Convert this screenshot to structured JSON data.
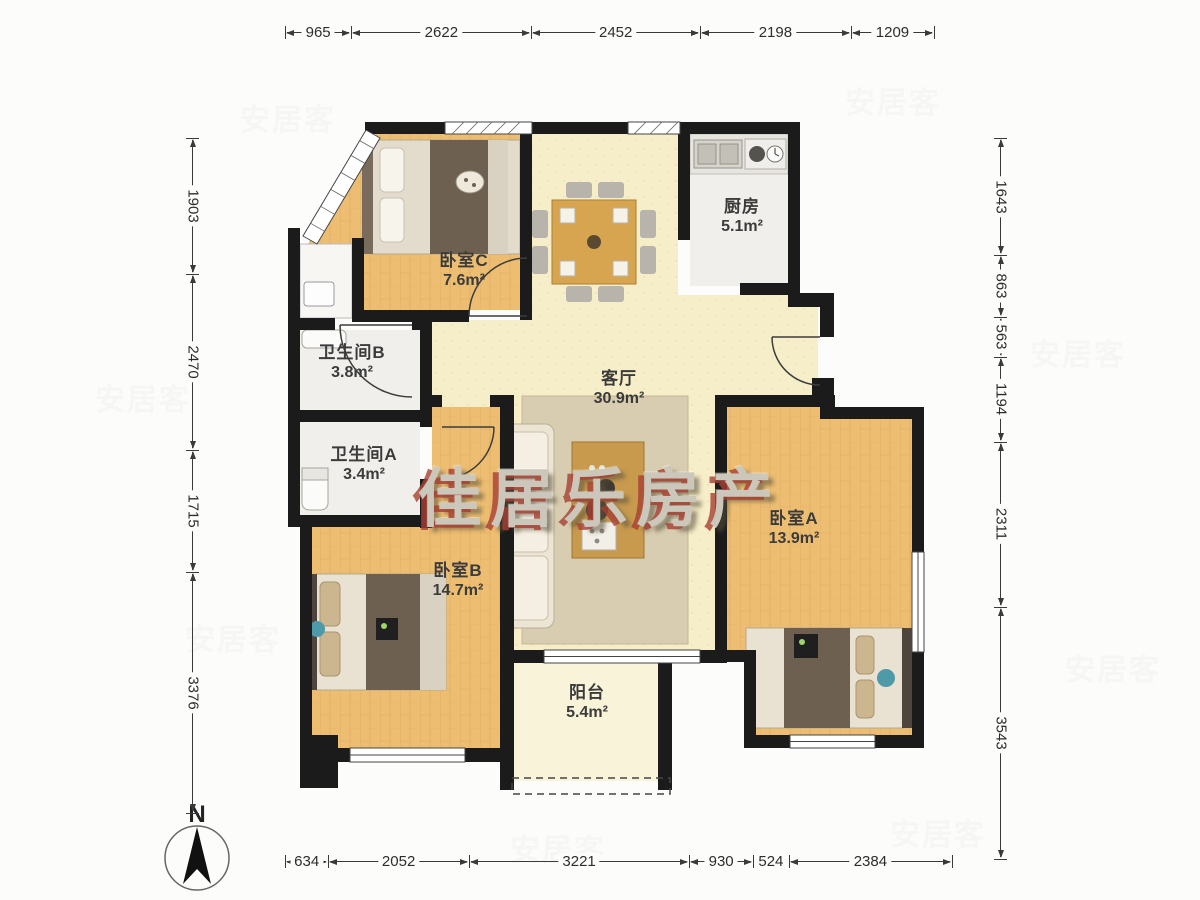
{
  "watermark": {
    "agency": "佳居乐房产",
    "site": "安居客"
  },
  "compass": {
    "label": "N"
  },
  "rooms": [
    {
      "id": "bedroom-c",
      "name": "卧室C",
      "area": "7.6m²"
    },
    {
      "id": "kitchen",
      "name": "厨房",
      "area": "5.1m²"
    },
    {
      "id": "bathroom-b",
      "name": "卫生间B",
      "area": "3.8m²"
    },
    {
      "id": "bathroom-a",
      "name": "卫生间A",
      "area": "3.4m²"
    },
    {
      "id": "living",
      "name": "客厅",
      "area": "30.9m²"
    },
    {
      "id": "bedroom-a",
      "name": "卧室A",
      "area": "13.9m²"
    },
    {
      "id": "bedroom-b",
      "name": "卧室B",
      "area": "14.7m²"
    },
    {
      "id": "balcony",
      "name": "阳台",
      "area": "5.4m²"
    }
  ],
  "dimensions": {
    "top": [
      "965",
      "2622",
      "2452",
      "2198",
      "1209"
    ],
    "bottom": [
      "634",
      "2052",
      "3221",
      "930",
      "524",
      "2384"
    ],
    "left": [
      "1903",
      "2470",
      "1715",
      "3376"
    ],
    "right": [
      "1643",
      "863",
      "563",
      "1194",
      "2311",
      "3543"
    ]
  },
  "colors": {
    "wall": "#1b1b1b",
    "wood_floor": "#edbe72",
    "living_floor": "#f6eec9",
    "tile_floor": "#f0efeb",
    "balcony_floor": "#f9f3da",
    "watermark_red": "#a63e32"
  }
}
